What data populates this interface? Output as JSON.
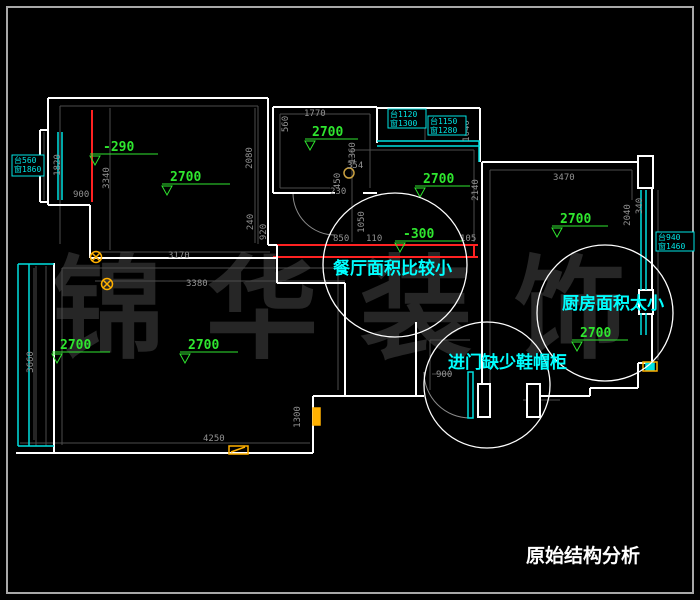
{
  "title": "原始结构分析",
  "watermark": "锦华装饰",
  "notes": [
    "餐厅面积比较小",
    "厨房面积太小",
    "进门缺少鞋帽柜"
  ],
  "height_labels": [
    "-290",
    "2700",
    "2700",
    "2700",
    "-300",
    "2700",
    "2700",
    "2700",
    "2700"
  ],
  "window_tags": [
    {
      "l1": "台560",
      "l2": "窗1860"
    },
    {
      "l1": "台1120",
      "l2": "窗1300"
    },
    {
      "l1": "台1150",
      "l2": "窗1280"
    },
    {
      "l1": "台940",
      "l2": "窗1460"
    }
  ],
  "dims": [
    "1770",
    "560",
    "2080",
    "3340",
    "1820",
    "900",
    "3170",
    "3380",
    "920",
    "240",
    "354",
    "450",
    "230",
    "1360",
    "1050",
    "110",
    "105",
    "850",
    "2140",
    "3470",
    "2040",
    "340",
    "3660",
    "4250",
    "1300",
    "900",
    "1040"
  ],
  "colors": {
    "background": "#000000",
    "wall": "#ffffff",
    "window": "#00e0e0",
    "beam": "#ff2222",
    "height_label": "#2fe62f",
    "dimension": "#929292",
    "note_text": "#00ffff",
    "symbol": "#ffb000",
    "watermark": "#262626",
    "frame": "#a8a8a8"
  }
}
